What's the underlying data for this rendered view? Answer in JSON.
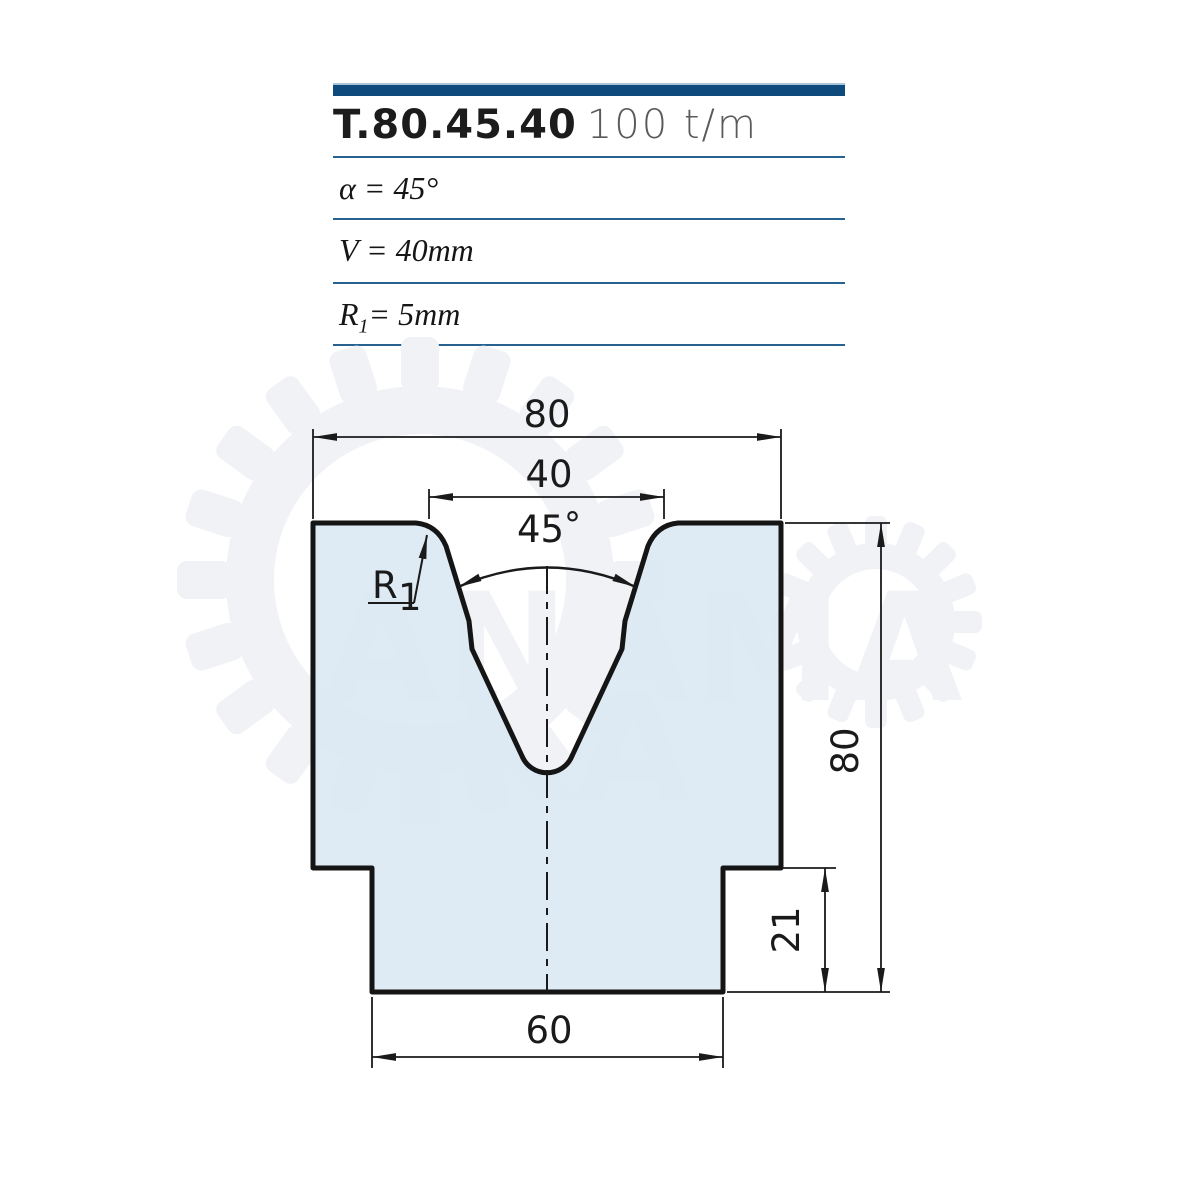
{
  "header": {
    "model": "T.80.45.40",
    "capacity": "100 t/m"
  },
  "specs": {
    "alpha": "α = 45°",
    "v": "V = 40mm",
    "r_prefix": "R",
    "r_sub": "1",
    "r_rest": "= 5mm"
  },
  "dims": {
    "top_width": "80",
    "v_opening": "40",
    "angle": "45",
    "degree": "°",
    "radius": "R",
    "radius_sub": "1",
    "height": "80",
    "step_height": "21",
    "bottom_width": "60"
  },
  "watermark": {
    "row1": "ANAMA",
    "row2": "KA"
  },
  "colors": {
    "accent_bar": "#0e4a7c",
    "separator_blue": "#26618f",
    "die_fill": "#dbeaf3",
    "outline": "#151515",
    "watermark_gray": "#f0f2f5"
  }
}
